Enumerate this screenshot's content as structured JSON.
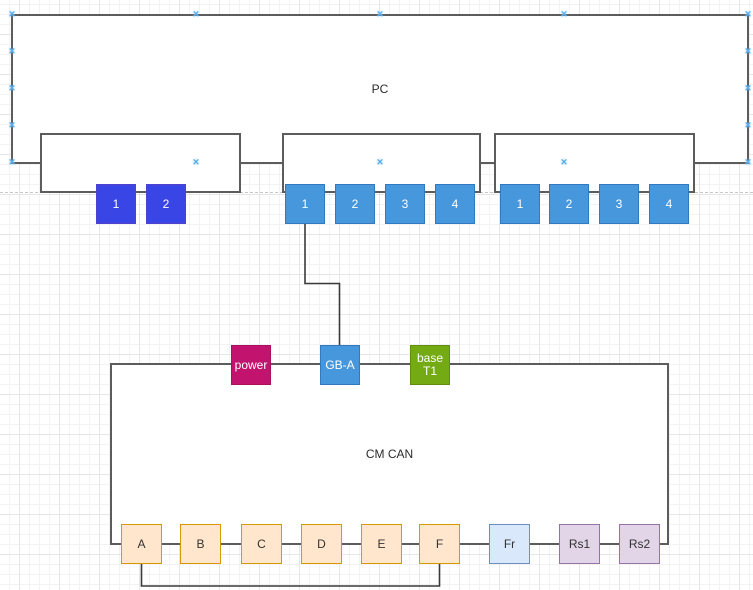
{
  "pc": {
    "label": "PC",
    "groups": [
      {
        "name": "adapter-1",
        "style": "indigo",
        "ports": [
          "1",
          "2"
        ]
      },
      {
        "name": "adapter-2",
        "style": "blue",
        "ports": [
          "1",
          "2",
          "3",
          "4"
        ]
      },
      {
        "name": "adapter-3",
        "style": "blue",
        "ports": [
          "1",
          "2",
          "3",
          "4"
        ]
      }
    ]
  },
  "cm_can": {
    "label": "CM CAN",
    "top_connectors": [
      {
        "label": "power",
        "style": "magenta"
      },
      {
        "label": "GB-A",
        "style": "blue"
      },
      {
        "label": "base T1",
        "line1": "base",
        "line2": "T1",
        "style": "green"
      }
    ],
    "bottom_ports": [
      "A",
      "B",
      "C",
      "D",
      "E",
      "F",
      "Fr",
      "Rs1",
      "Rs2"
    ]
  },
  "icons": {
    "connection_point_glyph": "×"
  },
  "palette": {
    "grid_minor": "#f3f3f6",
    "grid_major": "#e7e7ea",
    "divider": "#c8c8c8",
    "box_border": "#5c5c5c",
    "wire": "#3a3a3a",
    "cp_color": "#58aef0",
    "indigo_fill": "#3a45e6",
    "indigo_border": "#5142c9",
    "blue_fill": "#4797dc",
    "blue_border": "#3379be",
    "magenta_fill": "#c2136f",
    "magenta_border": "#ad0e62",
    "green_fill": "#74ab15",
    "green_border": "#608e11",
    "orange_fill": "#ffe6cc",
    "orange_border": "#d79b00",
    "frblue_fill": "#dae8fc",
    "frblue_border": "#6c8ebf",
    "purple_fill": "#e1d5e7",
    "purple_border": "#9673a6"
  }
}
